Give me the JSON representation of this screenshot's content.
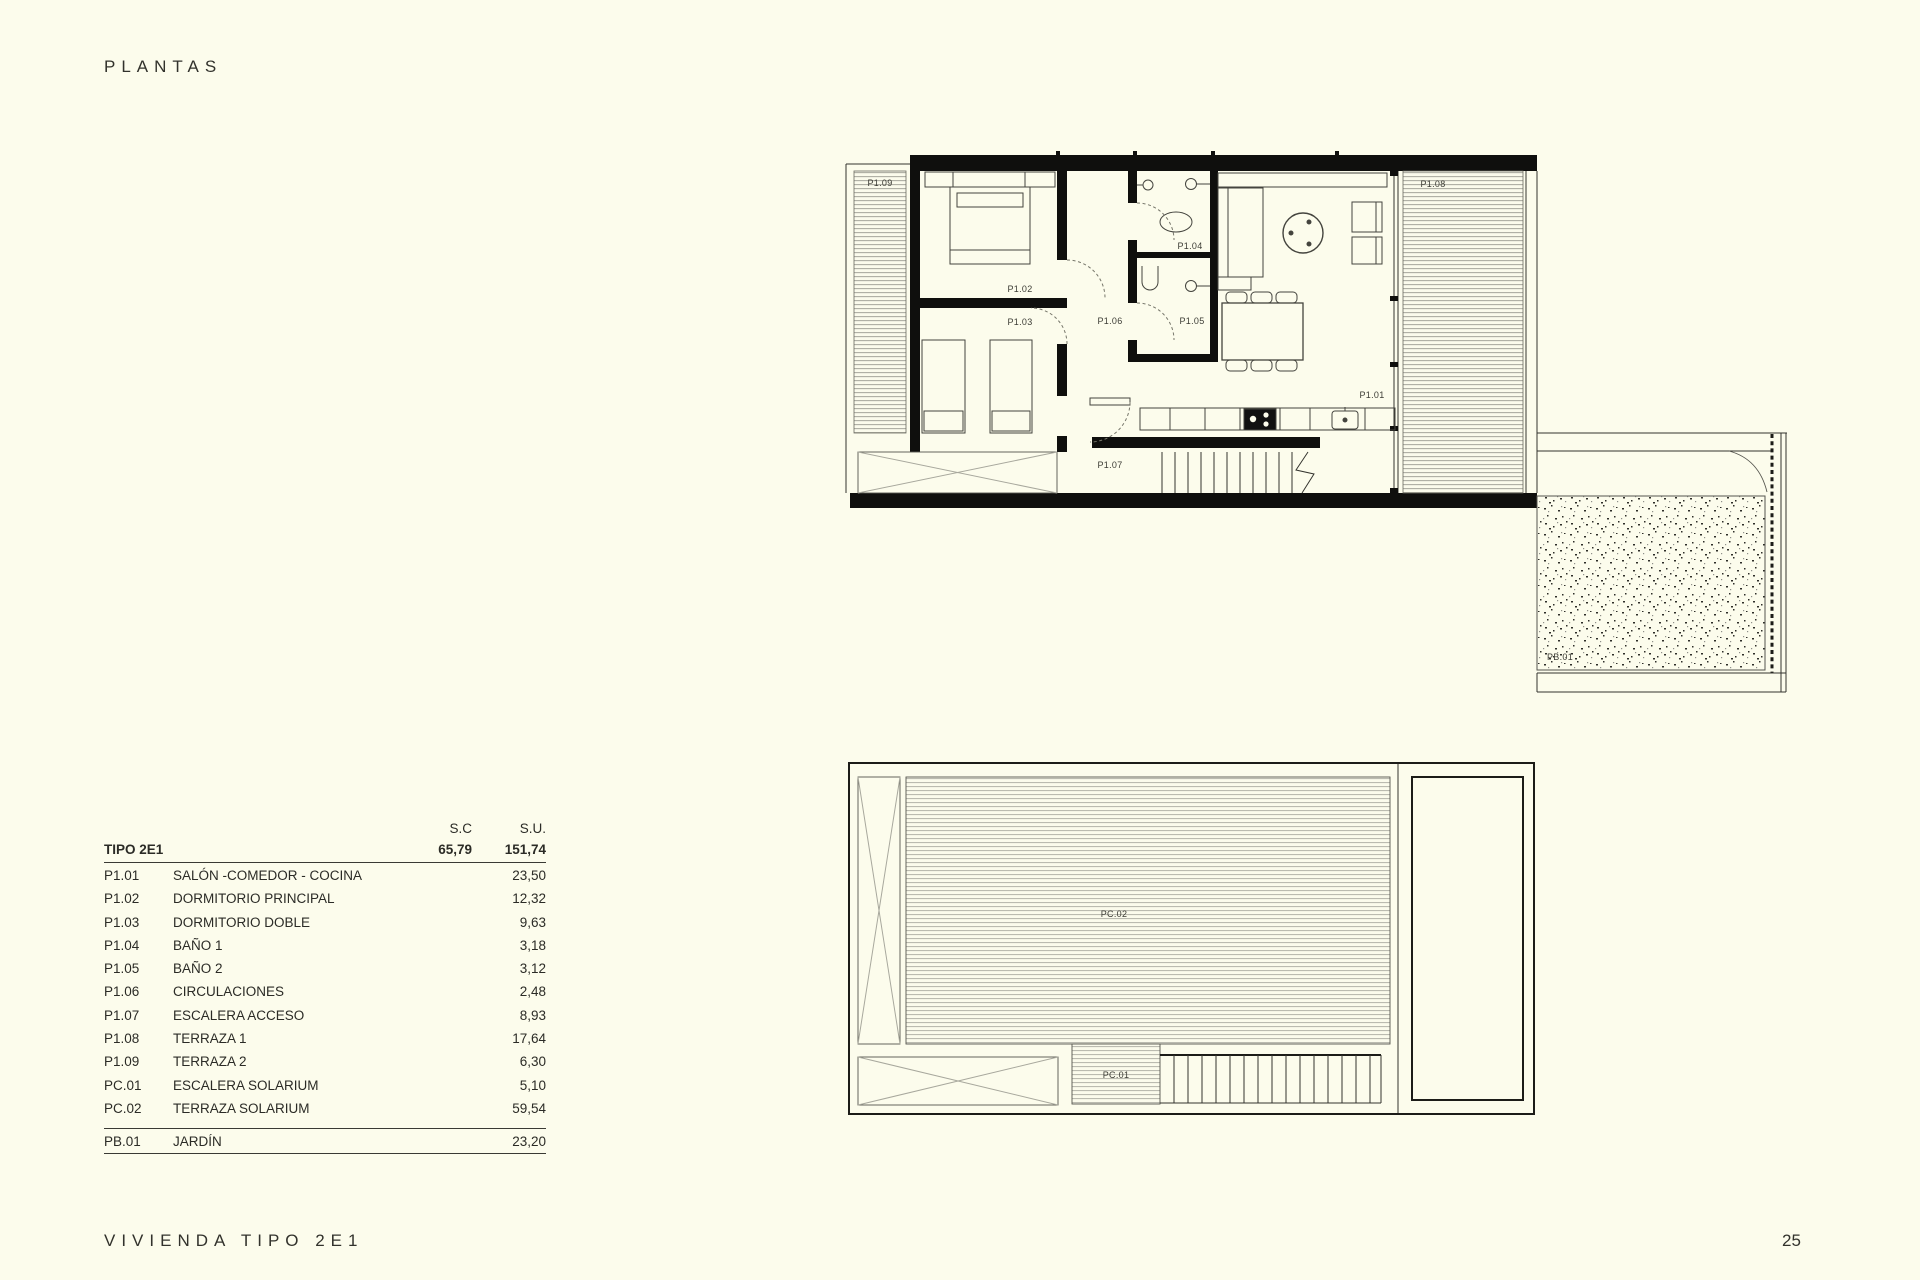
{
  "page": {
    "title": "PLANTAS",
    "footer_left": "VIVIENDA TIPO 2E1",
    "page_number": "25",
    "background_color": "#fcfcec",
    "wall_color": "#0f0f0d"
  },
  "table": {
    "col_sc": "S.C",
    "col_su": "S.U.",
    "type_row": {
      "code": "TIPO 2E1",
      "sc": "65,79",
      "su": "151,74"
    },
    "rows": [
      {
        "code": "P1.01",
        "name": "SALÓN -COMEDOR - COCINA",
        "su": "23,50"
      },
      {
        "code": "P1.02",
        "name": "DORMITORIO PRINCIPAL",
        "su": "12,32"
      },
      {
        "code": "P1.03",
        "name": "DORMITORIO DOBLE",
        "su": "9,63"
      },
      {
        "code": "P1.04",
        "name": "BAÑO 1",
        "su": "3,18"
      },
      {
        "code": "P1.05",
        "name": "BAÑO 2",
        "su": "3,12"
      },
      {
        "code": "P1.06",
        "name": "CIRCULACIONES",
        "su": "2,48"
      },
      {
        "code": "P1.07",
        "name": "ESCALERA ACCESO",
        "su": "8,93"
      },
      {
        "code": "P1.08",
        "name": "TERRAZA 1",
        "su": "17,64"
      },
      {
        "code": "P1.09",
        "name": "TERRAZA 2",
        "su": "6,30"
      },
      {
        "code": "PC.01",
        "name": "ESCALERA SOLARIUM",
        "su": "5,10"
      },
      {
        "code": "PC.02",
        "name": "TERRAZA SOLARIUM",
        "su": "59,54"
      }
    ],
    "garden_row": {
      "code": "PB.01",
      "name": "JARDÍN",
      "su": "23,20"
    }
  },
  "plan_upper": {
    "labels": [
      {
        "text": "P1.09",
        "x": 40,
        "y": 46
      },
      {
        "text": "P1.02",
        "x": 180,
        "y": 152
      },
      {
        "text": "P1.03",
        "x": 180,
        "y": 185
      },
      {
        "text": "P1.06",
        "x": 270,
        "y": 184
      },
      {
        "text": "P1.04",
        "x": 350,
        "y": 109
      },
      {
        "text": "P1.05",
        "x": 352,
        "y": 184
      },
      {
        "text": "P1.01",
        "x": 532,
        "y": 258
      },
      {
        "text": "P1.07",
        "x": 270,
        "y": 328
      },
      {
        "text": "P1.08",
        "x": 593,
        "y": 47
      },
      {
        "text": "PB.01",
        "x": 720,
        "y": 520
      }
    ]
  },
  "plan_lower": {
    "labels": [
      {
        "text": "PC.02",
        "x": 266,
        "y": 155
      },
      {
        "text": "PC.01",
        "x": 268,
        "y": 316
      }
    ]
  }
}
